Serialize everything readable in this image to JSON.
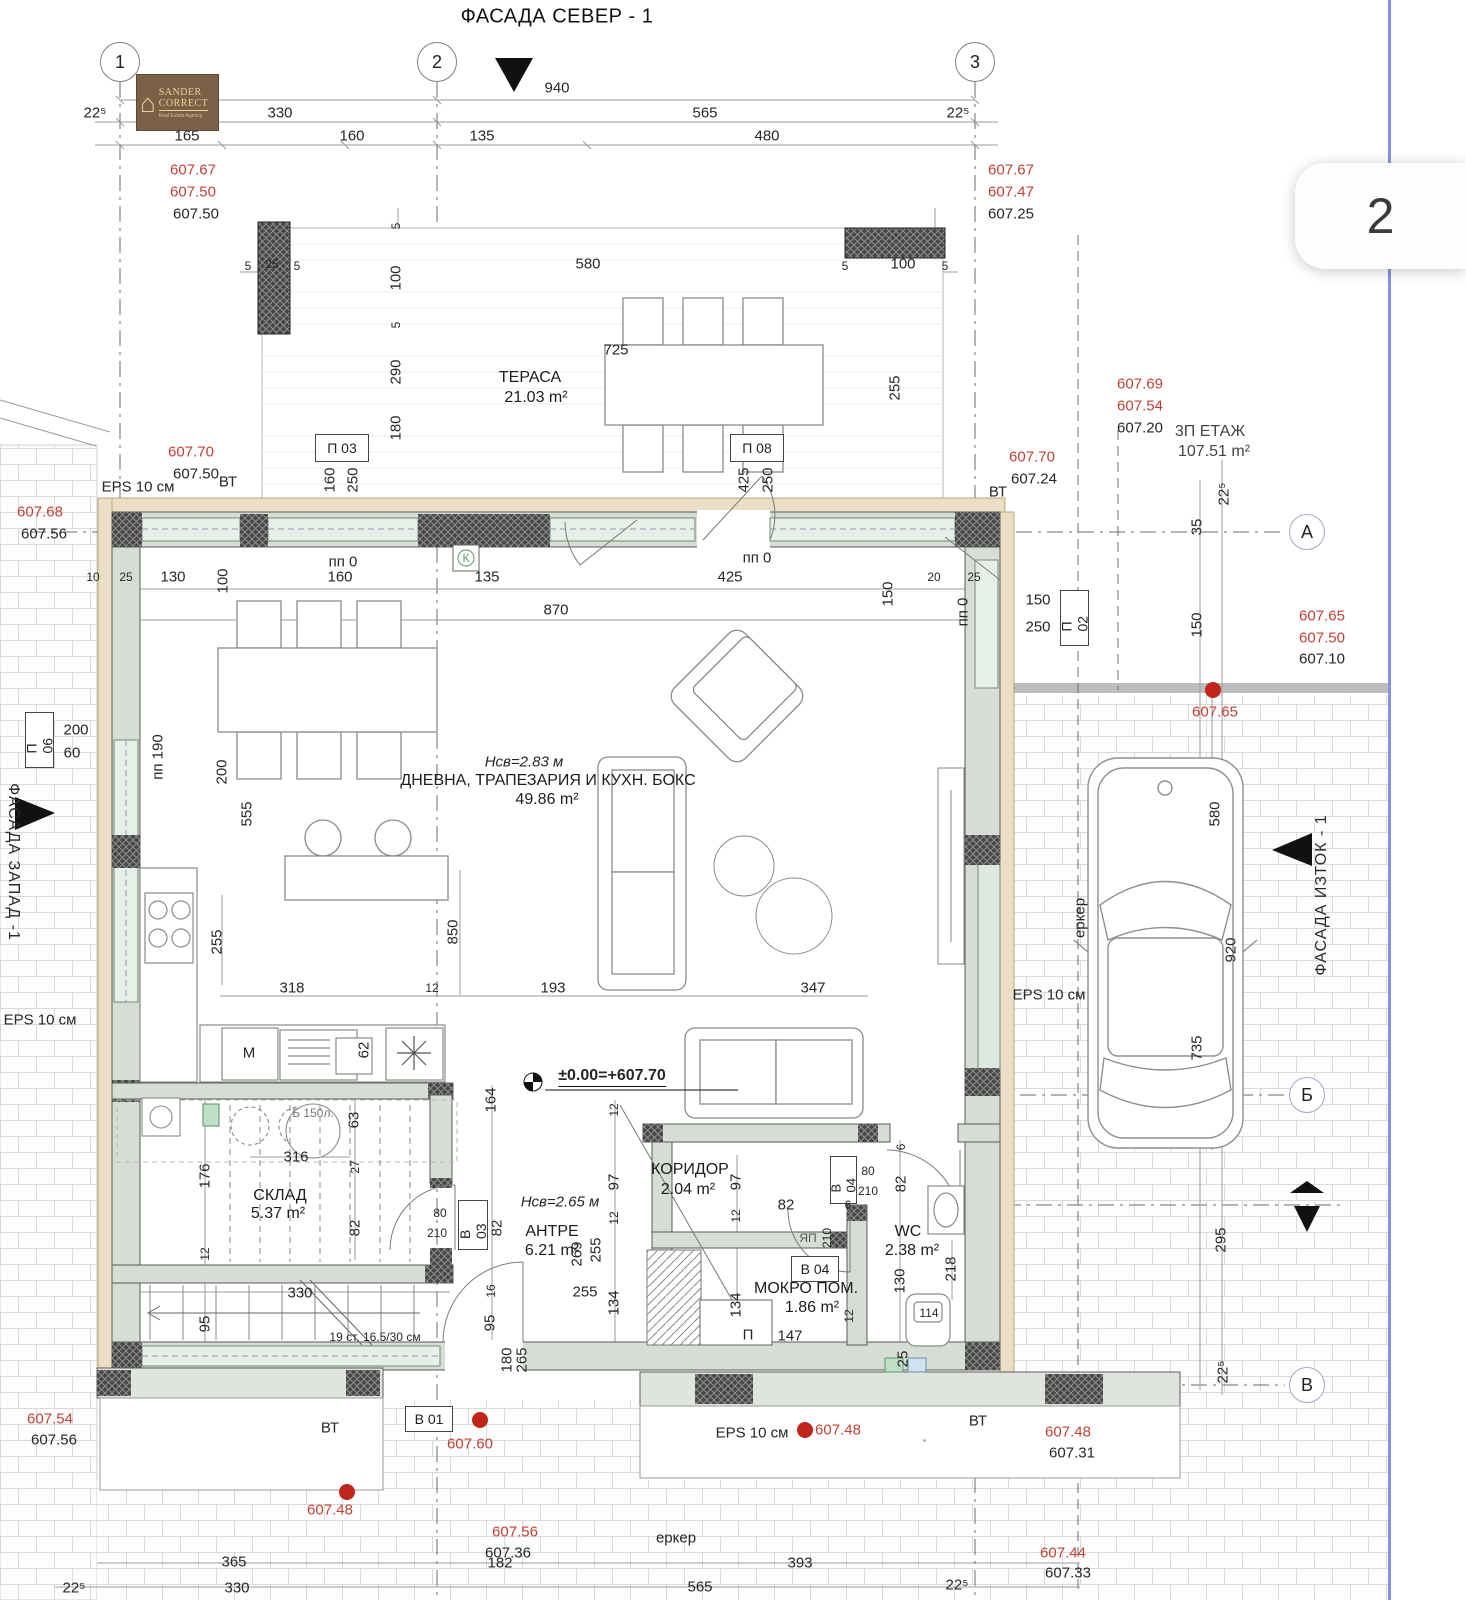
{
  "page": {
    "number": "2",
    "title": "ФАСАДА СЕВЕР - 1"
  },
  "logo": {
    "line1": "SANDER",
    "line2": "CORRECT",
    "line3": "Real Estate Agency"
  },
  "grid": {
    "c1": "1",
    "c2": "2",
    "c3": "3",
    "rA": "А",
    "rB": "Б",
    "rC": "В"
  },
  "facades": {
    "east": "ФАСАДА ИЗТОК - 1",
    "west": "ФАСАДА ЗАПАД -1"
  },
  "rooms": {
    "terrace": {
      "name": "ТЕРАСА",
      "area": "21.03 m²"
    },
    "living": {
      "height": "Нсв=2.83 м",
      "name": "ДНЕВНА, ТРАПЕЗАРИЯ И КУХН. БОКС",
      "area": "49.86 m²"
    },
    "sklad": {
      "name": "СКЛАД",
      "area": "5.37 m²"
    },
    "antre": {
      "height": "Нсв=2.65 м",
      "name": "АНТРЕ",
      "area": "6.21 m²"
    },
    "koridor": {
      "name": "КОРИДОР",
      "area": "2.04 m²"
    },
    "mokro": {
      "name": "МОКРО ПОМ.",
      "area": "1.86 m²"
    },
    "wc": {
      "name": "WC",
      "area": "2.38 m²"
    },
    "etage": {
      "name": "3П ЕТАЖ",
      "area": "107.51 m²"
    }
  },
  "level_mark": "±0.00=+607.70",
  "stair_note": "19 ст. 16.5/30 см",
  "boiler": "Б 150л.",
  "erker": "еркер",
  "eps": "EPS 10 см",
  "vt": "ВТ",
  "pp0": "пп 0",
  "pp190": "пп 190",
  "washer": "M",
  "k_sign": "К",
  "p_sign": "П",
  "yap": "ЯП",
  "openings": {
    "p03": "П 03",
    "p08": "П 08",
    "p06": "П 06",
    "p02": "П 02",
    "v01": "В 01",
    "v03": "В 03",
    "v04": "В 04"
  },
  "colors": {
    "red": "#bf4135",
    "wall": "#d6ddd4",
    "hatch": "#4a4a4a",
    "insulation": "#eadfc4",
    "blue_line": "#8892df"
  },
  "dims": [
    "940",
    "22⁵",
    "330",
    "565",
    "22⁵",
    "165",
    "160",
    "135",
    "480",
    "5",
    "25",
    "5",
    "580",
    "5",
    "100",
    "5",
    "5",
    "100",
    "5",
    "290",
    "180",
    "160",
    "250",
    "725",
    "425",
    "250",
    "255",
    "10",
    "25",
    "130",
    "100",
    "160",
    "135",
    "425",
    "20",
    "25",
    "870",
    "150",
    "200",
    "555",
    "200",
    "60",
    "255",
    "318",
    "12",
    "193",
    "347",
    "850",
    "62",
    "164",
    "12",
    "97",
    "12",
    "255",
    "269",
    "97",
    "12",
    "134",
    "134",
    "255",
    "147",
    "316",
    "63",
    "176",
    "27",
    "82",
    "12",
    "330",
    "95",
    "80",
    "210",
    "82",
    "16",
    "95",
    "180",
    "265",
    "82",
    "6",
    "80",
    "210",
    "6",
    "82",
    "210",
    "130",
    "218",
    "25",
    "114",
    "12",
    "150",
    "250",
    "22⁵",
    "35",
    "150",
    "580",
    "920",
    "735",
    "295",
    "22⁵",
    "365",
    "330",
    "22⁵",
    "182",
    "393",
    "565",
    "22⁵"
  ],
  "red_elev": [
    "607.67",
    "607.50",
    "607.67",
    "607.47",
    "607.70",
    "607.70",
    "607.68",
    "607.69",
    "607.54",
    "607.65",
    "607.50",
    "607.65",
    "607.54",
    "607.60",
    "607.48",
    "607.48",
    "607.48",
    "607.56",
    "607.44"
  ],
  "black_elev": [
    "607.50",
    "607.25",
    "607.50",
    "607.24",
    "607.56",
    "607.20",
    "607.10",
    "607.56",
    "607.36",
    "607.31",
    "607.33"
  ]
}
